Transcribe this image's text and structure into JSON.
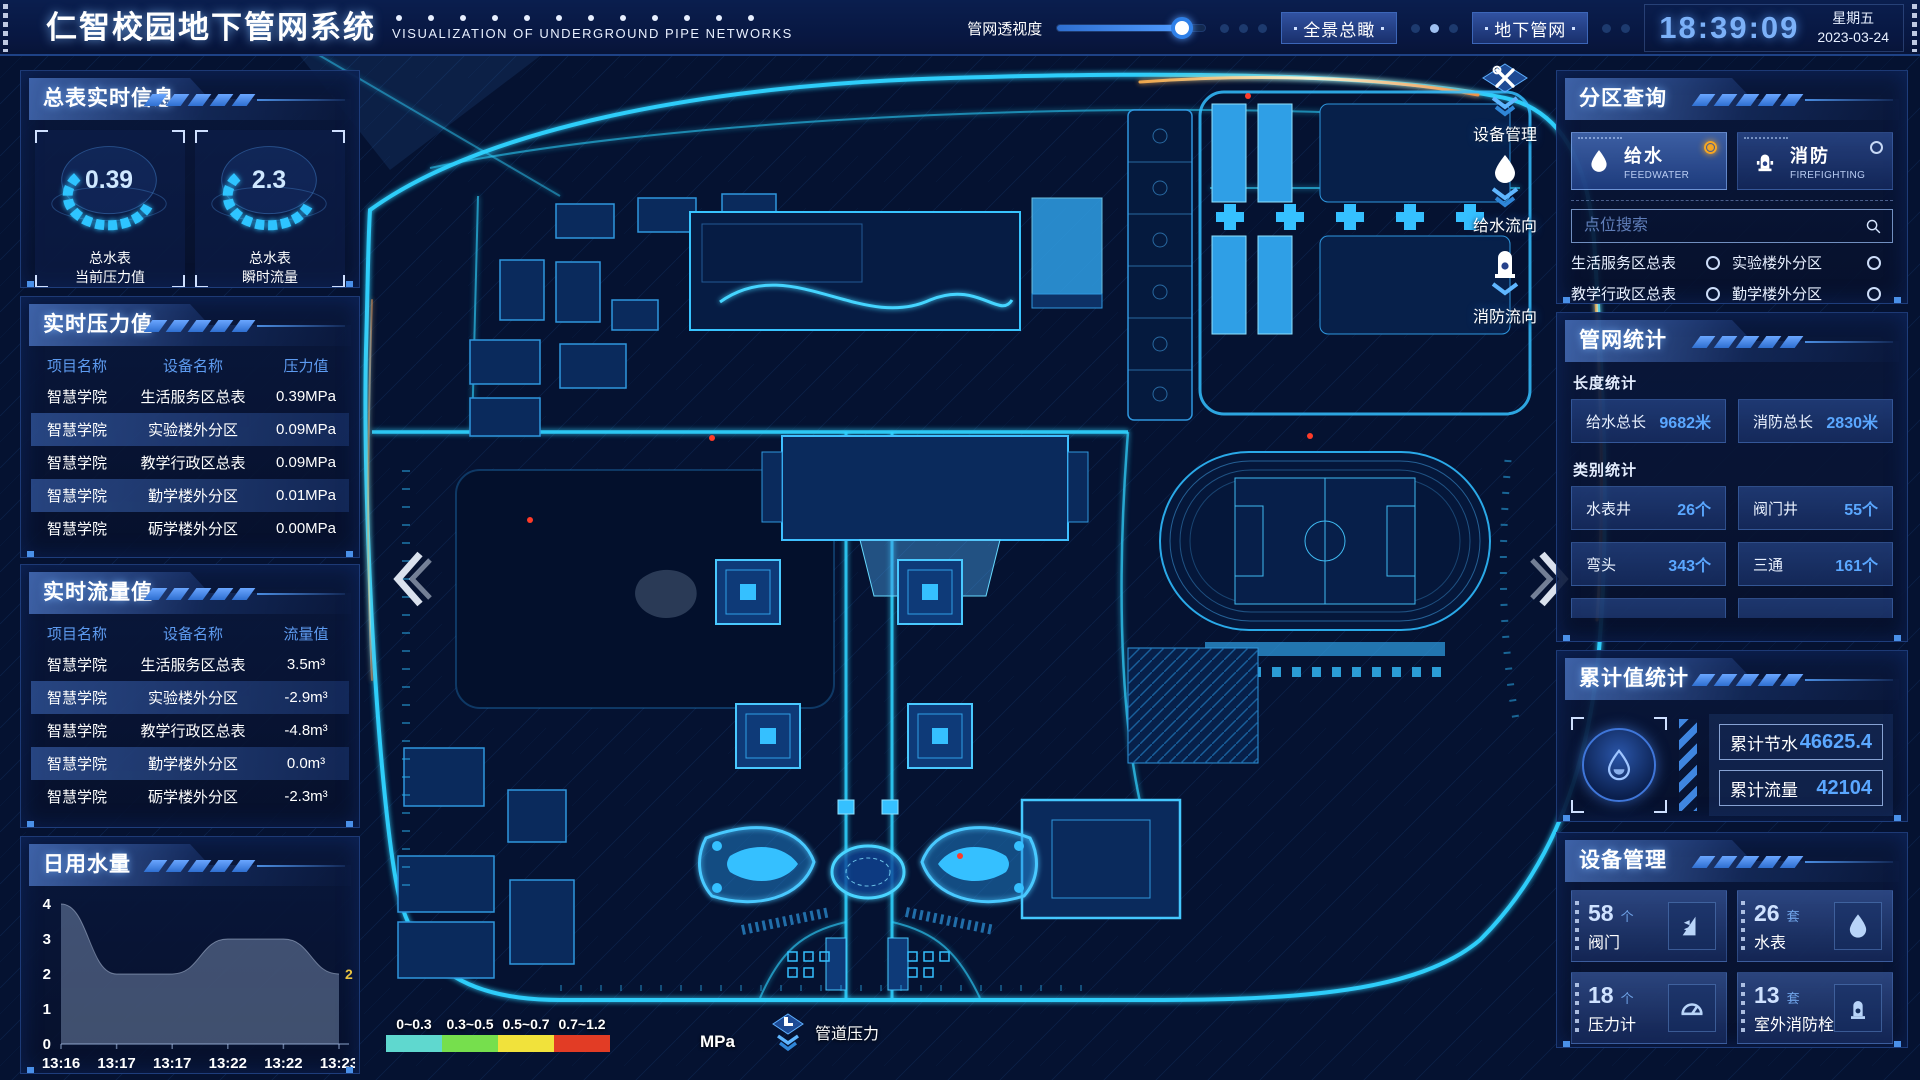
{
  "header": {
    "title": "仁智校园地下管网系统",
    "subtitle": "VISUALIZATION OF UNDERGROUND PIPE NETWORKS",
    "opacity_label": "管网透视度",
    "opacity_percent": 84,
    "btn_overview": "全景总瞰",
    "btn_underground": "地下管网",
    "time": "18:39:09",
    "weekday": "星期五",
    "date": "2023-03-24"
  },
  "left": {
    "meter_info": {
      "title": "总表实时信息",
      "gauges": [
        {
          "value": "0.39",
          "label1": "总水表",
          "label2": "当前压力值"
        },
        {
          "value": "2.3",
          "label1": "总水表",
          "label2": "瞬时流量"
        }
      ]
    },
    "pressure": {
      "title": "实时压力值",
      "headers": [
        "项目名称",
        "设备名称",
        "压力值"
      ],
      "rows": [
        [
          "智慧学院",
          "生活服务区总表",
          "0.39MPa"
        ],
        [
          "智慧学院",
          "实验楼外分区",
          "0.09MPa"
        ],
        [
          "智慧学院",
          "教学行政区总表",
          "0.09MPa"
        ],
        [
          "智慧学院",
          "勤学楼外分区",
          "0.01MPa"
        ],
        [
          "智慧学院",
          "砺学楼外分区",
          "0.00MPa"
        ]
      ]
    },
    "flow": {
      "title": "实时流量值",
      "headers": [
        "项目名称",
        "设备名称",
        "流量值"
      ],
      "rows": [
        [
          "智慧学院",
          "生活服务区总表",
          "3.5m³"
        ],
        [
          "智慧学院",
          "实验楼外分区",
          "-2.9m³"
        ],
        [
          "智慧学院",
          "教学行政区总表",
          "-4.8m³"
        ],
        [
          "智慧学院",
          "勤学楼外分区",
          "0.0m³"
        ],
        [
          "智慧学院",
          "砺学楼外分区",
          "-2.3m³"
        ]
      ]
    },
    "daily": {
      "title": "日用水量"
    }
  },
  "chart_data": {
    "type": "area",
    "title": "日用水量",
    "x": [
      "13:16",
      "13:17",
      "13:17",
      "13:22",
      "13:22",
      "13:23"
    ],
    "values": [
      4,
      2,
      2,
      3,
      3,
      2
    ],
    "ylim": [
      0,
      4
    ],
    "yticks": [
      0,
      1,
      2,
      3,
      4
    ],
    "end_label": "2",
    "xlabel": "",
    "ylabel": "",
    "grid": false,
    "legend_position": "none"
  },
  "right": {
    "zone_query": {
      "title": "分区查询",
      "tabs": [
        {
          "label": "给水",
          "sub": "FEEDWATER",
          "selected": true
        },
        {
          "label": "消防",
          "sub": "FIREFIGHTING",
          "selected": false
        }
      ],
      "search_placeholder": "点位搜索",
      "points": [
        {
          "label": "生活服务区总表"
        },
        {
          "label": "实验楼外分区"
        },
        {
          "label": "教学行政区总表"
        },
        {
          "label": "勤学楼外分区"
        },
        {
          "label": "砺学楼外分区"
        },
        {
          "label": "宿舍区泵房"
        }
      ]
    },
    "pipe_stats": {
      "title": "管网统计",
      "length_title": "长度统计",
      "length_stats": [
        {
          "label": "给水总长",
          "value": "9682米"
        },
        {
          "label": "消防总长",
          "value": "2830米"
        }
      ],
      "category_title": "类别统计",
      "category_stats": [
        {
          "label": "水表井",
          "value": "26个"
        },
        {
          "label": "阀门井",
          "value": "55个"
        },
        {
          "label": "弯头",
          "value": "343个"
        },
        {
          "label": "三通",
          "value": "161个"
        }
      ]
    },
    "cumulative": {
      "title": "累计值统计",
      "stats": [
        {
          "label": "累计节水",
          "value": "46625.4"
        },
        {
          "label": "累计流量",
          "value": "42104"
        }
      ]
    },
    "devices": {
      "title": "设备管理",
      "cards": [
        {
          "count": "58",
          "unit": "个",
          "label": "阀门",
          "icon": "valve-icon"
        },
        {
          "count": "26",
          "unit": "套",
          "label": "水表",
          "icon": "water-meter-icon"
        },
        {
          "count": "18",
          "unit": "个",
          "label": "压力计",
          "icon": "pressure-gauge-icon"
        },
        {
          "count": "13",
          "unit": "套",
          "label": "室外消防栓",
          "icon": "hydrant-icon"
        }
      ]
    }
  },
  "map": {
    "controls": [
      {
        "label": "设备管理",
        "icon": "tools-icon"
      },
      {
        "label": "给水流向",
        "icon": "water-drop-icon"
      },
      {
        "label": "消防流向",
        "icon": "hydrant-icon"
      }
    ],
    "legend": {
      "ranges": [
        {
          "label": "0~0.3",
          "color": "#5fd8cf"
        },
        {
          "label": "0.3~0.5",
          "color": "#76df4d"
        },
        {
          "label": "0.5~0.7",
          "color": "#f1e23b"
        },
        {
          "label": "0.7~1.2",
          "color": "#e23c25"
        }
      ],
      "unit": "MPa",
      "label": "管道压力"
    }
  }
}
